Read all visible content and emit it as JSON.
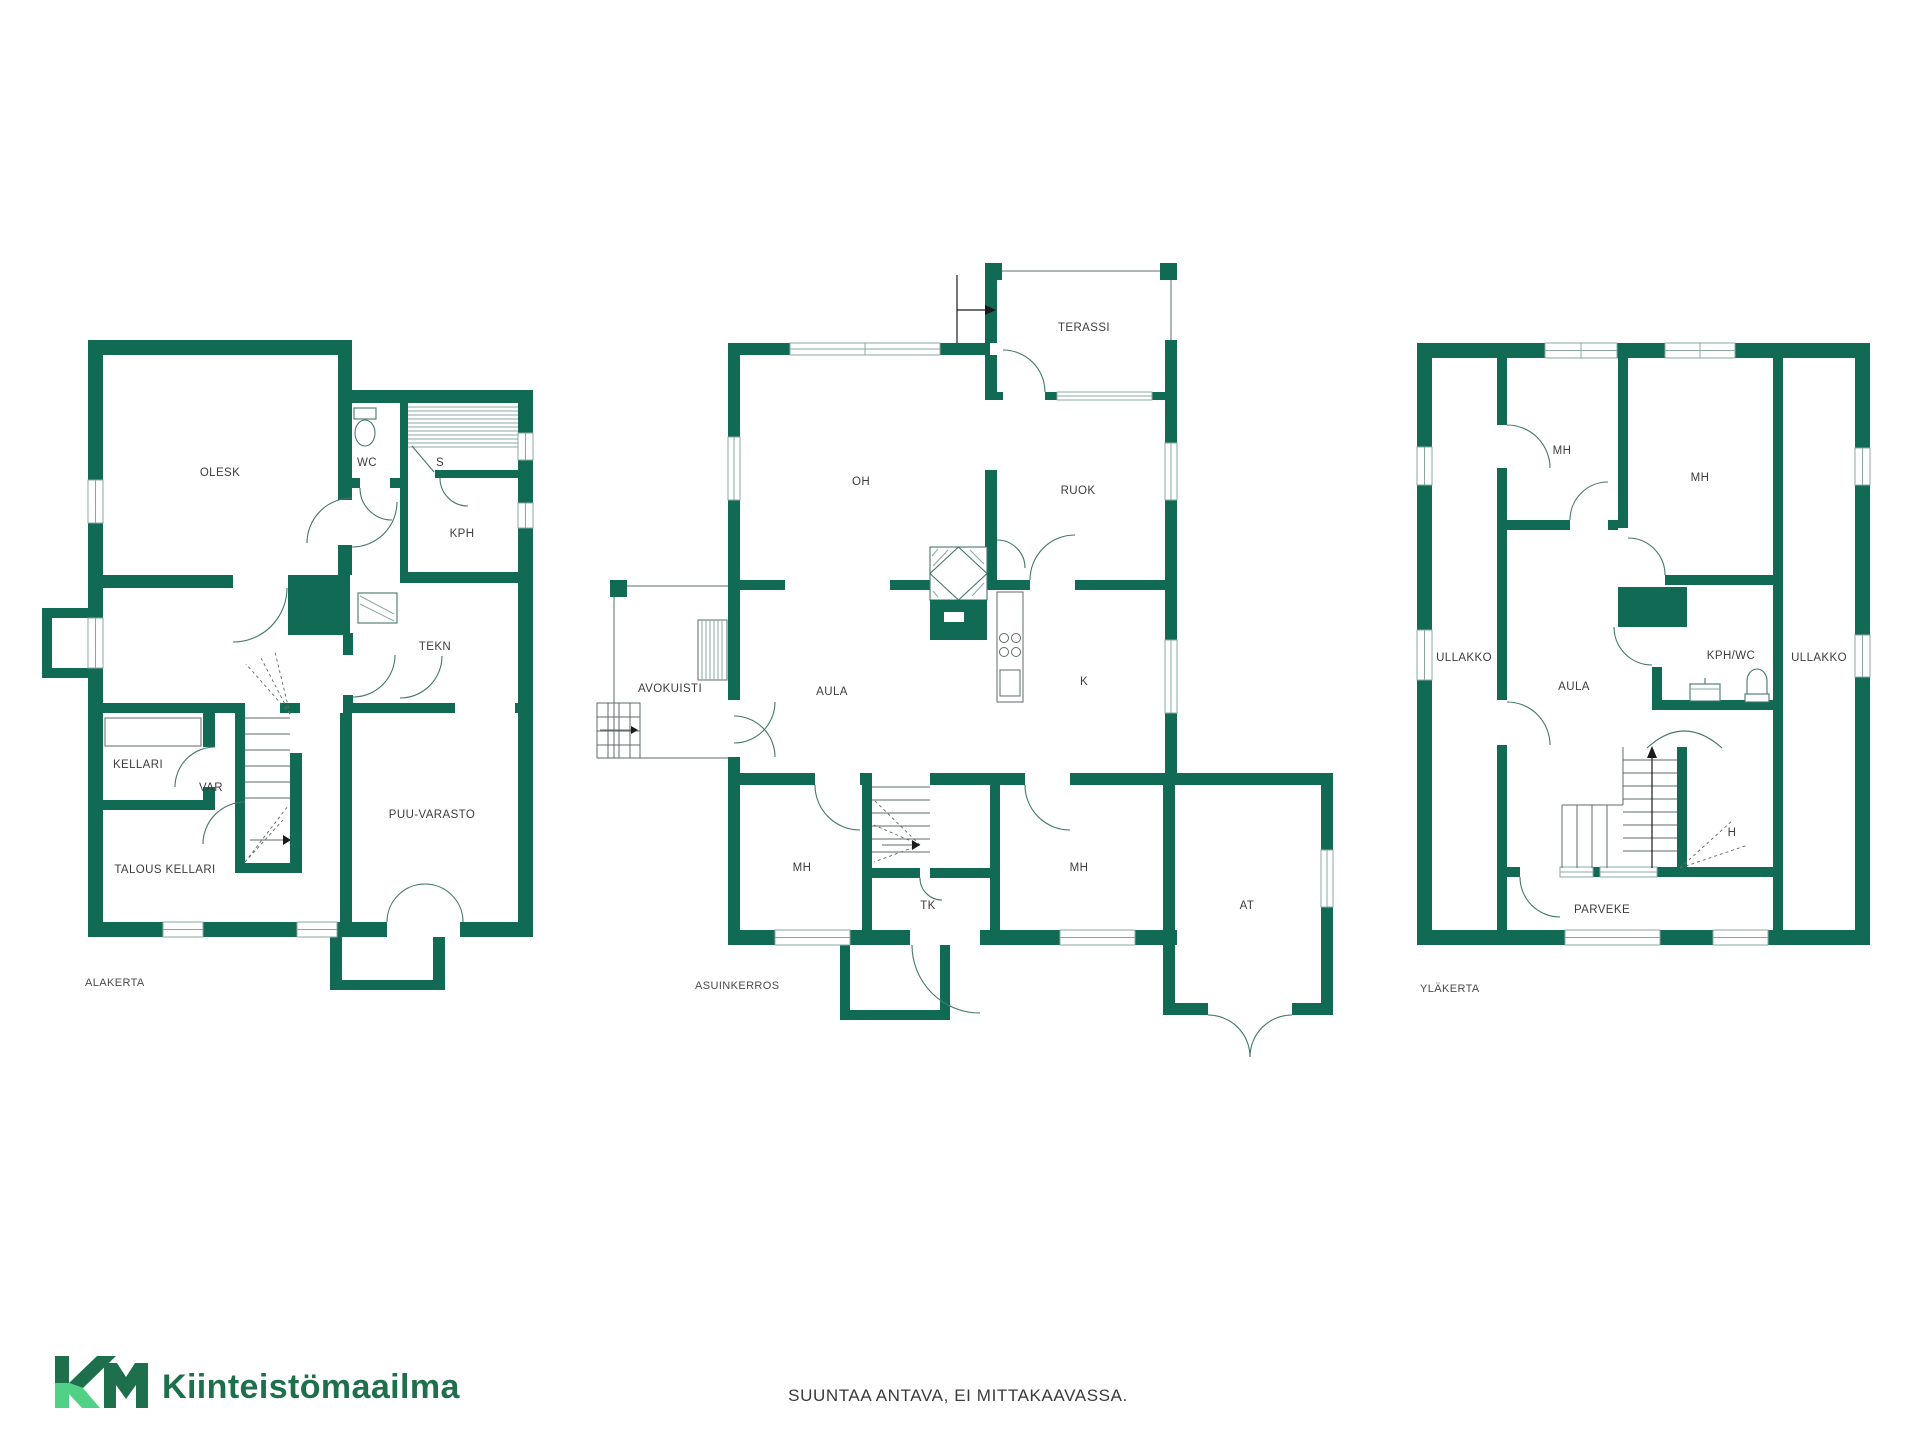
{
  "page": {
    "footer_note": "SUUNTAA ANTAVA, EI MITTAKAAVASSA."
  },
  "logo": {
    "initials": "KM",
    "company": "Kiinteistömaailma"
  },
  "colors": {
    "wall": "#116a53",
    "label": "#3d3d3d",
    "floor": "#4a4a4a",
    "arc": "#44776a",
    "line": "#8aa8a0",
    "stair": "#5f6b68",
    "footer": "#3a3a3a",
    "logo-dark": "#1e6f4c",
    "logo-light": "#50d185"
  },
  "floors": [
    {
      "label": "ALAKERTA",
      "rooms": [
        {
          "label": "OLESK"
        },
        {
          "label": "WC"
        },
        {
          "label": "S"
        },
        {
          "label": "KPH"
        },
        {
          "label": "TEKN"
        },
        {
          "label": "KELLARI"
        },
        {
          "label": "VAR"
        },
        {
          "label": "PUU-VARASTO"
        },
        {
          "label": "TALOUS KELLARI"
        }
      ]
    },
    {
      "label": "ASUINKERROS",
      "rooms": [
        {
          "label": "TERASSI"
        },
        {
          "label": "OH"
        },
        {
          "label": "RUOK"
        },
        {
          "label": "AVOKUISTI"
        },
        {
          "label": "AULA"
        },
        {
          "label": "K"
        },
        {
          "label": "MH"
        },
        {
          "label": "TK"
        },
        {
          "label": "MH"
        },
        {
          "label": "AT"
        }
      ]
    },
    {
      "label": "YLÄKERTA",
      "rooms": [
        {
          "label": "MH"
        },
        {
          "label": "MH"
        },
        {
          "label": "ULLAKKO"
        },
        {
          "label": "AULA"
        },
        {
          "label": "KPH/WC"
        },
        {
          "label": "ULLAKKO"
        },
        {
          "label": "H"
        },
        {
          "label": "PARVEKE"
        }
      ]
    }
  ]
}
